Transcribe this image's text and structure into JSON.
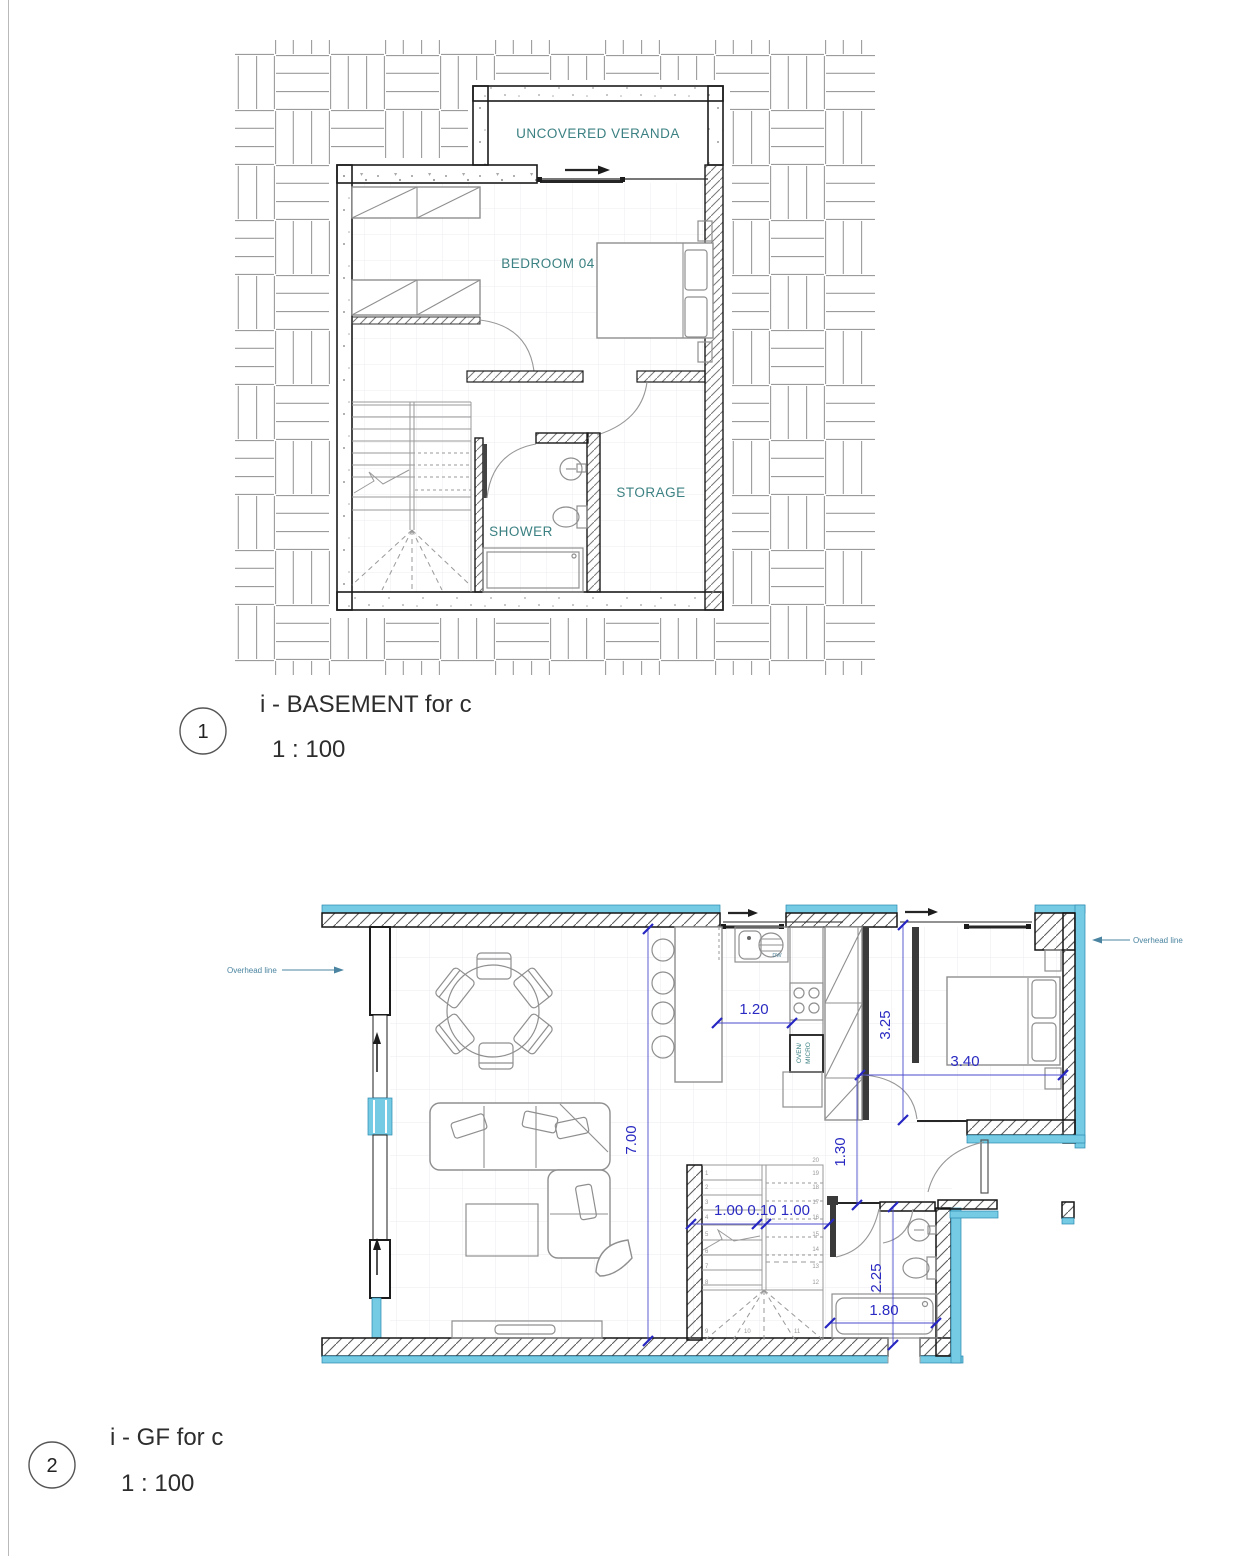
{
  "colors": {
    "room_label": "#3b8082",
    "dimension_text": "#2a2ac2",
    "dimension_line": "#4a4ace",
    "wall_highlight": "#74cbe3",
    "annotation": "#4a84a0",
    "hatch_line": "#9b9b9b"
  },
  "basement_plan": {
    "number": "1",
    "title": "i  - BASEMENT for c",
    "scale": "1 : 100",
    "labels": {
      "veranda": "UNCOVERED VERANDA",
      "bedroom": "BEDROOM 04",
      "shower": "SHOWER",
      "storage": "STORAGE"
    }
  },
  "ground_floor_plan": {
    "number": "2",
    "title": "i - GF for c",
    "scale": "1 : 100",
    "labels": {
      "overhead_left": "Overhead line",
      "overhead_right": "Overhead line",
      "oven_micro_line1": "OVEN/",
      "oven_micro_line2": "MICRO",
      "dishwasher": "DW"
    },
    "dimensions": {
      "kitchen_island_width": "1.20",
      "closet_run_depth": "3.25",
      "bedroom_bed_width": "3.40",
      "living_room_depth": "7.00",
      "hallway_width": "1.30",
      "stair_flights": "1.00 0.10 1.00",
      "bathroom_depth": "2.25",
      "bathtub_length": "1.80"
    },
    "stair_step_numbers": {
      "left": [
        "1",
        "2",
        "3",
        "4",
        "5",
        "6",
        "7",
        "8",
        "9"
      ],
      "bottom": [
        "10",
        "11"
      ],
      "right": [
        "20",
        "19",
        "18",
        "17",
        "16",
        "15",
        "14",
        "13",
        "12"
      ]
    }
  }
}
